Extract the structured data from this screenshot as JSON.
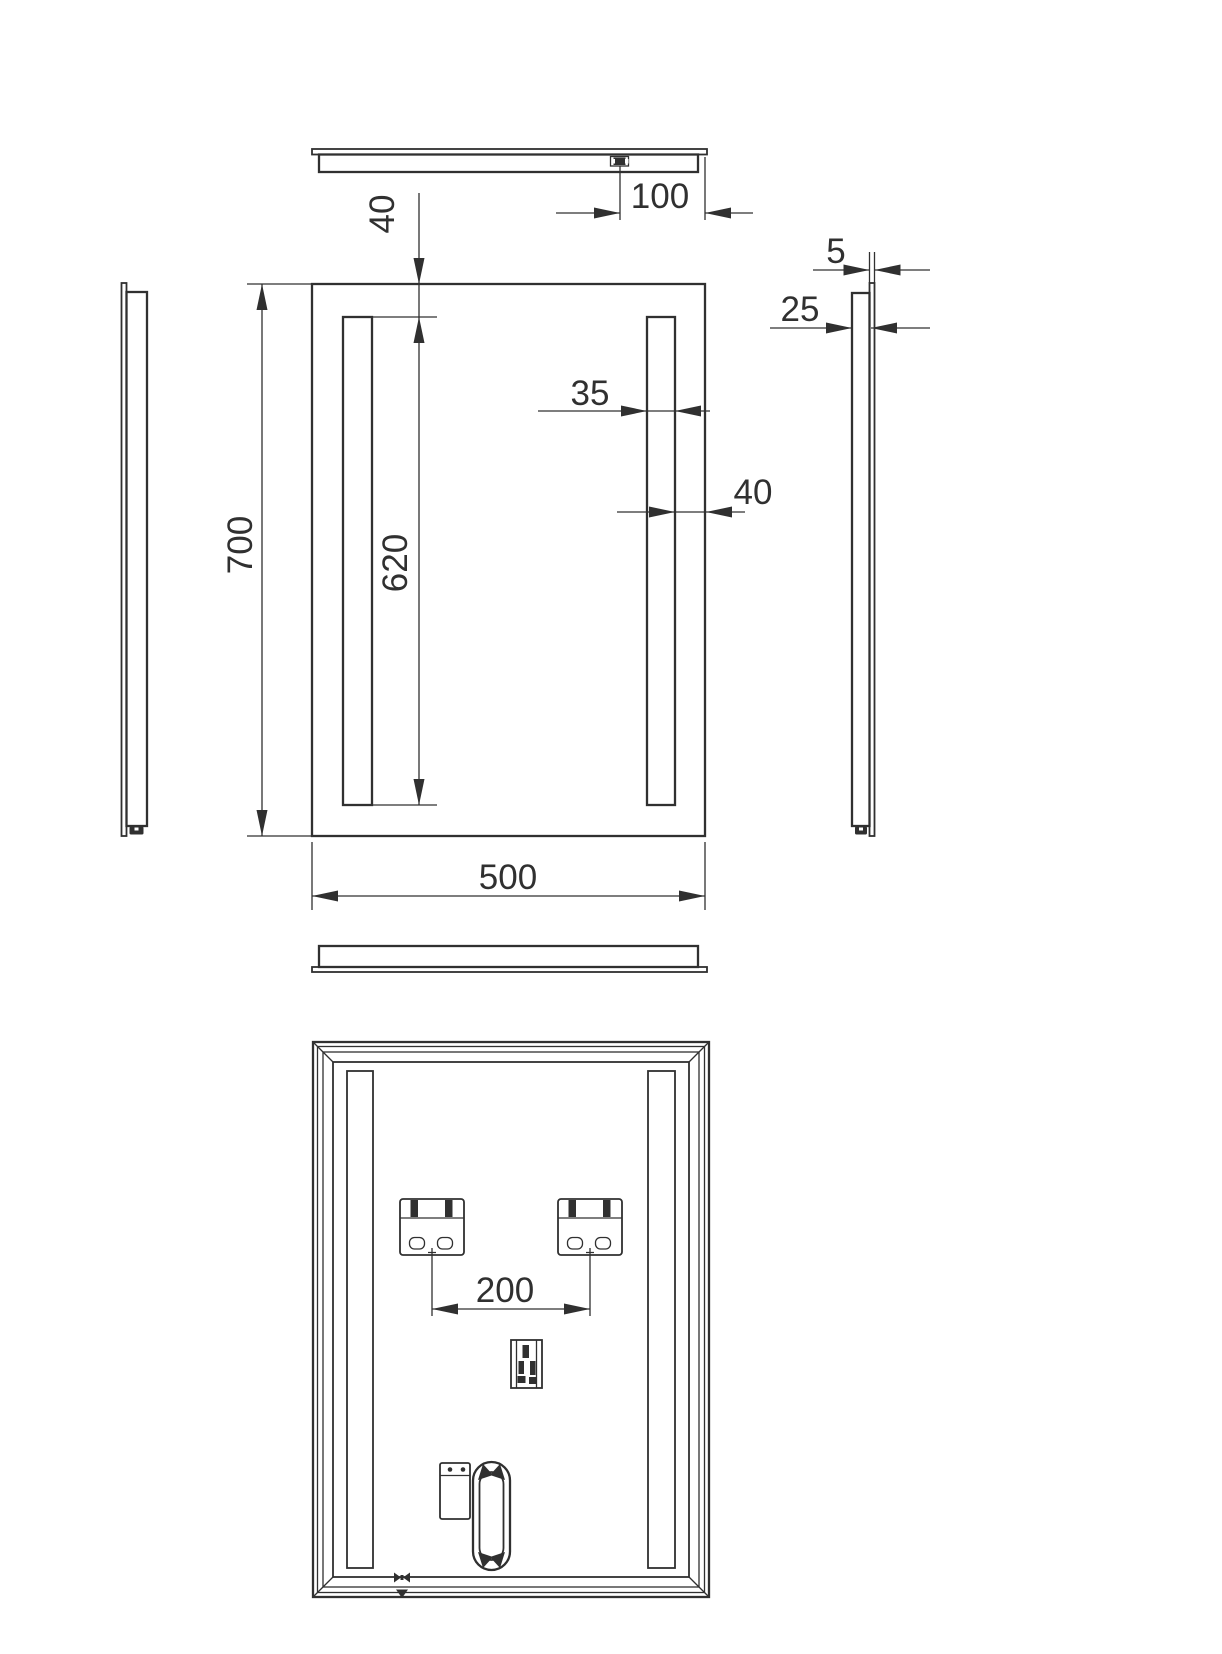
{
  "colors": {
    "line": "#303030",
    "background": "#ffffff"
  },
  "dimensions": {
    "switch_to_edge": "100",
    "strip_top_offset": "40",
    "mirror_height": "700",
    "light_strip_length": "620",
    "light_strip_width": "35",
    "strip_to_edge": "40",
    "mirror_width": "500",
    "glass_thickness": "5",
    "housing_depth": "25",
    "bracket_spacing": "200"
  }
}
